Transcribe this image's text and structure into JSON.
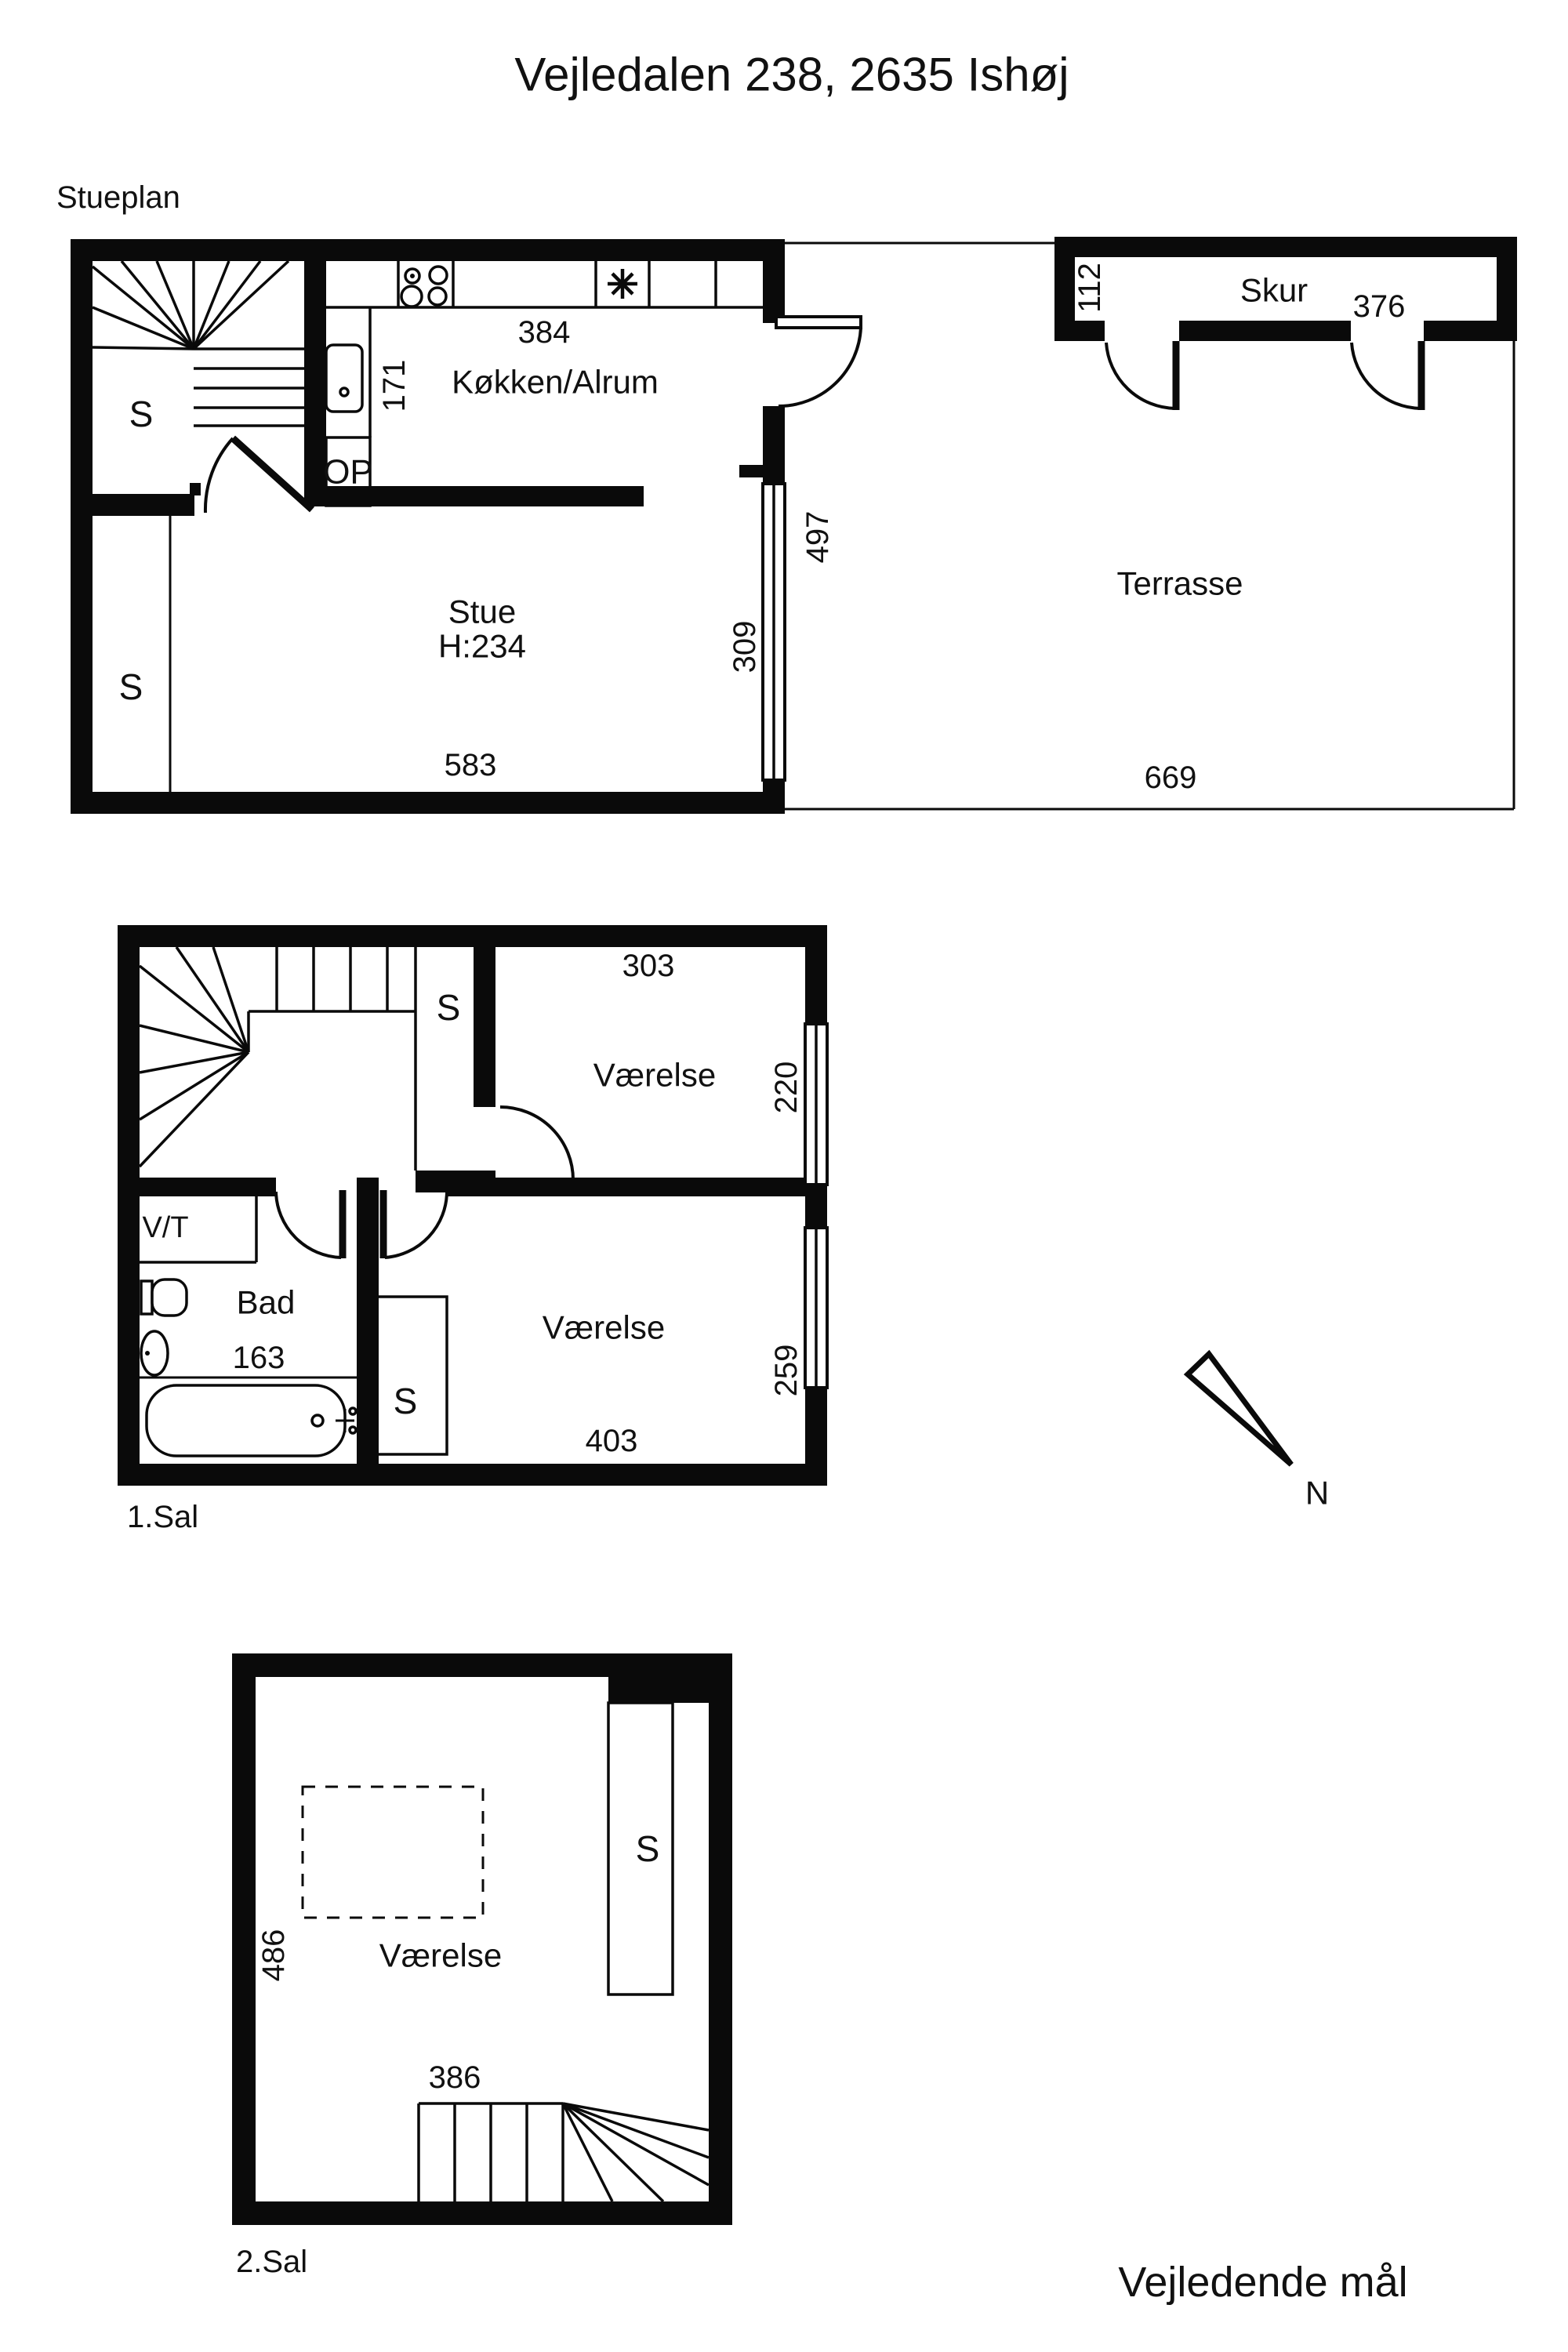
{
  "title": "Vejledalen 238, 2635 Ishøj",
  "footer_note": "Vejledende mål",
  "compass_label": "N",
  "colors": {
    "line": "#0a0a0a",
    "burner_fill": "#c9c9c9",
    "background": "#ffffff"
  },
  "stueplan": {
    "label": "Stueplan",
    "rooms": {
      "kitchen": "Køkken/Alrum",
      "living": "Stue",
      "living_ceiling": "H:234",
      "terrace": "Terrasse",
      "shed": "Skur",
      "stairs_up": "OP",
      "closet_hall": "S",
      "closet_living": "S"
    },
    "dims": {
      "kitchen_width": "384",
      "kitchen_depth": "171",
      "living_width": "583",
      "living_window": "309",
      "terrace_depth": "497",
      "terrace_width": "669",
      "shed_depth": "112",
      "shed_width": "376"
    }
  },
  "first_floor": {
    "label": "1.Sal",
    "rooms": {
      "room_north": "Værelse",
      "room_south": "Værelse",
      "bathroom": "Bad",
      "wc": "V/T",
      "closet_north": "S",
      "closet_south": "S"
    },
    "dims": {
      "room_north_width": "303",
      "room_north_window": "220",
      "bathroom_width": "163",
      "room_south_window": "259",
      "room_south_width": "403"
    }
  },
  "second_floor": {
    "label": "2.Sal",
    "rooms": {
      "room": "Værelse",
      "closet": "S"
    },
    "dims": {
      "room_depth": "486",
      "room_width": "386"
    }
  }
}
